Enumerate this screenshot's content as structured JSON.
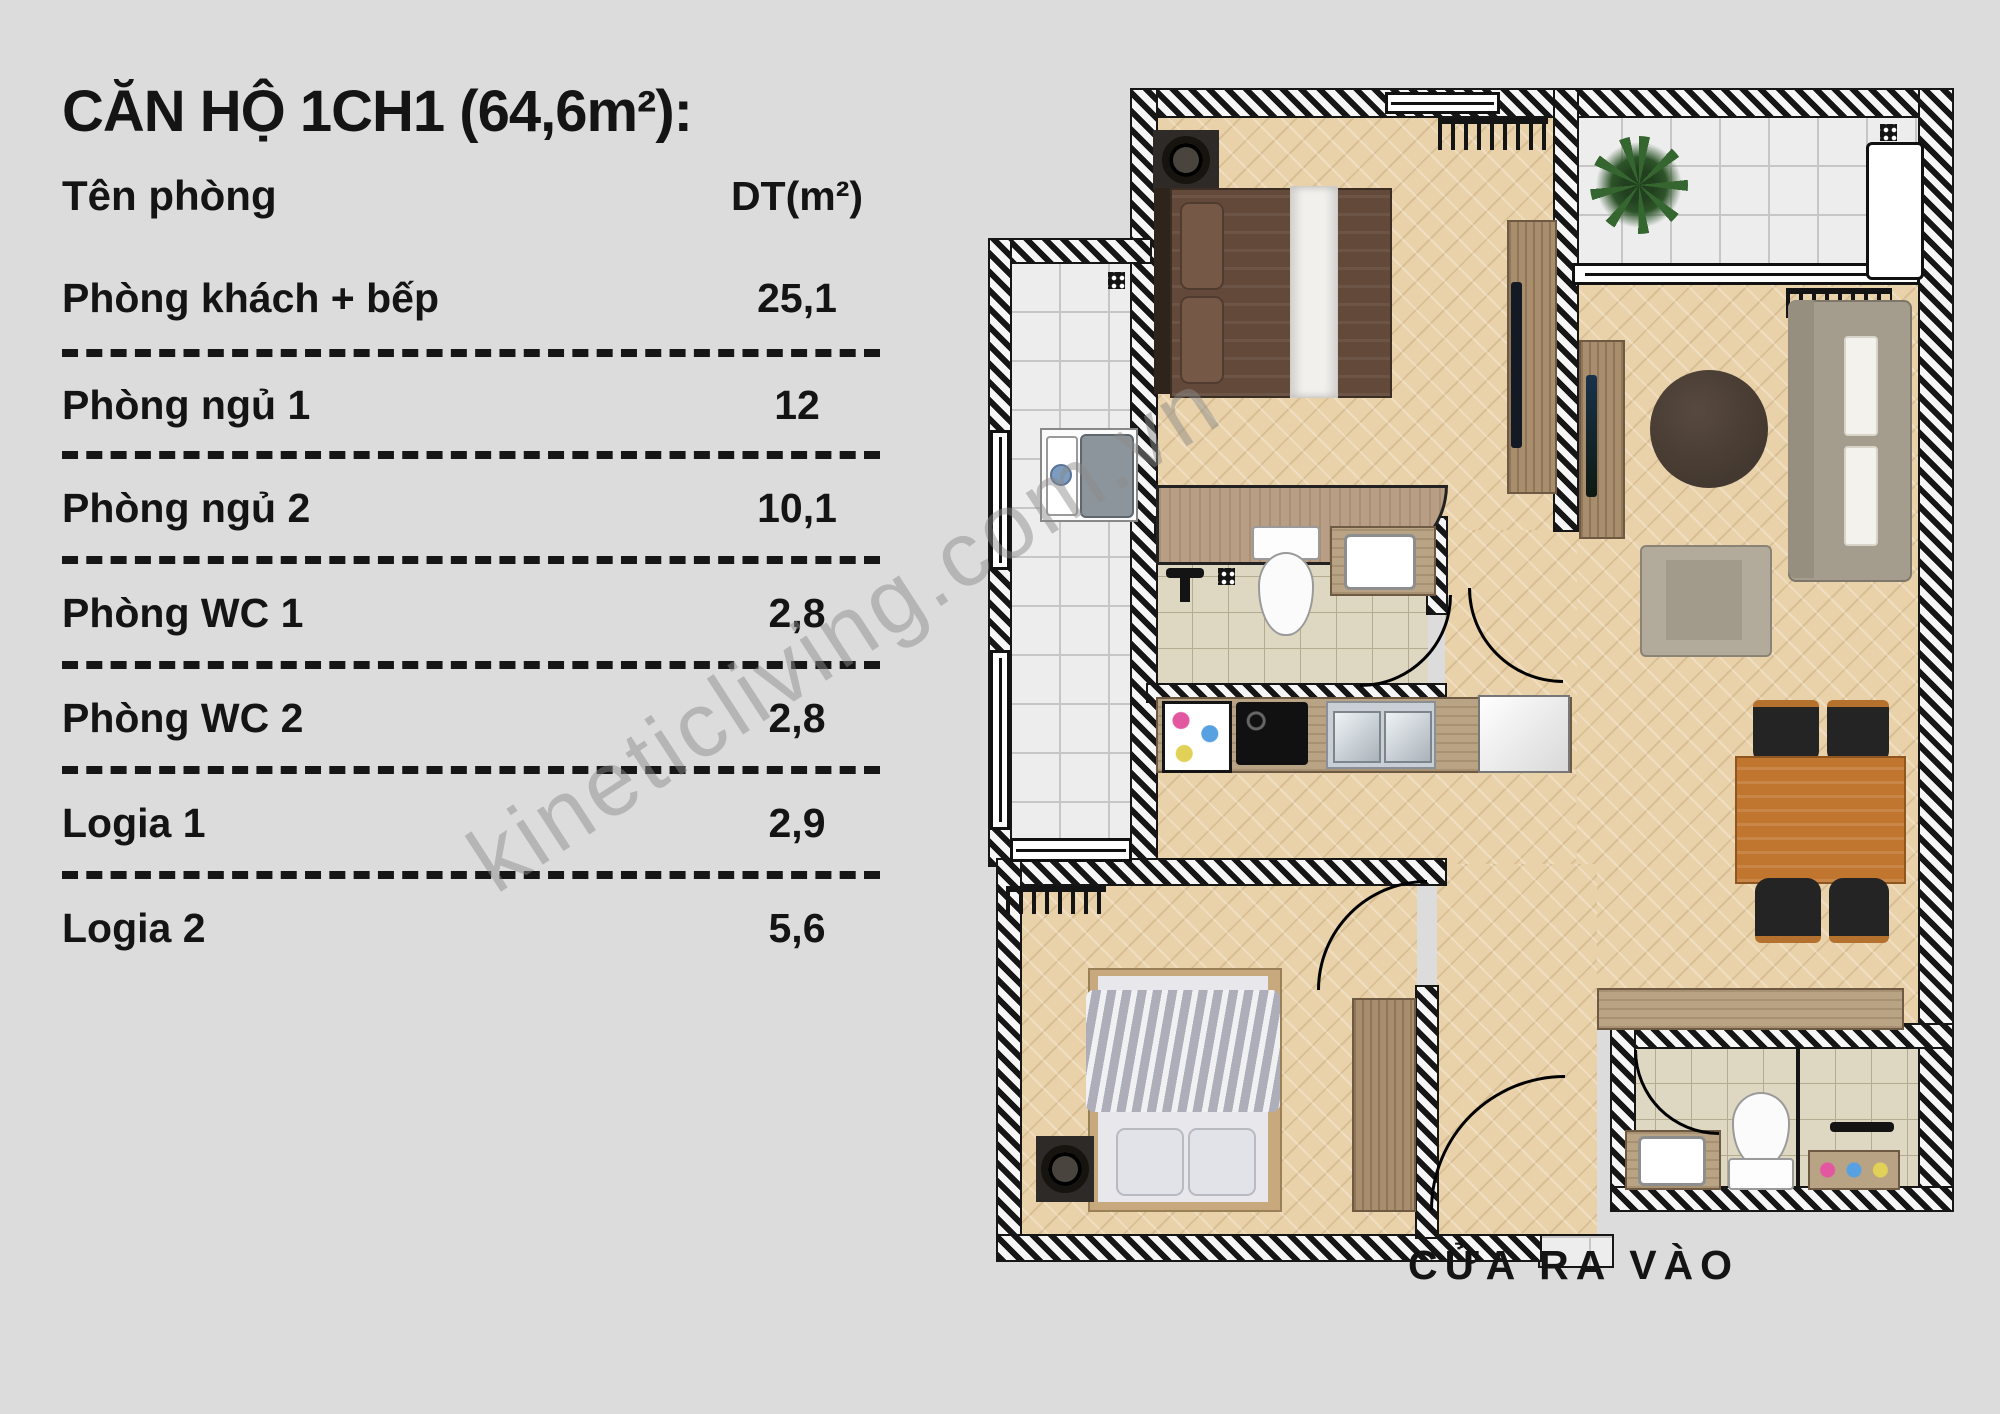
{
  "title": "CĂN HỘ 1CH1 (64,6m²):",
  "table": {
    "col_room": "Tên phòng",
    "col_area": "DT(m²)",
    "rows": [
      {
        "name": "Phòng khách + bếp",
        "area": "25,1"
      },
      {
        "name": "Phòng ngủ 1",
        "area": "12"
      },
      {
        "name": "Phòng ngủ 2",
        "area": "10,1"
      },
      {
        "name": "Phòng WC 1",
        "area": "2,8"
      },
      {
        "name": "Phòng WC 2",
        "area": "2,8"
      },
      {
        "name": "Logia 1",
        "area": "2,9"
      },
      {
        "name": "Logia 2",
        "area": "5,6"
      }
    ]
  },
  "plan": {
    "entrance_label": "CỬA RA VÀO",
    "watermark": "kineticliving.com.vn"
  },
  "colors": {
    "background": "#dcdcdc",
    "text": "#141414",
    "wood_floor": "#e9d2a9",
    "white_tile": "#ededed",
    "wc_tile": "#ded8c2",
    "dining_table": "#c0762f",
    "sofa": "#a49d8d",
    "bed1": "#63493a",
    "bed2_duvet": "#c6c6d0"
  },
  "icons": {
    "plant-icon": "css-conic-leaves",
    "drain-icon": "black-square-4-dots",
    "speaker-icon": "dark-box-circle",
    "hanger-rail-icon": "comb-hooks",
    "shower-icon": "black-fixture",
    "door-arc-icon": "quarter-circle"
  }
}
